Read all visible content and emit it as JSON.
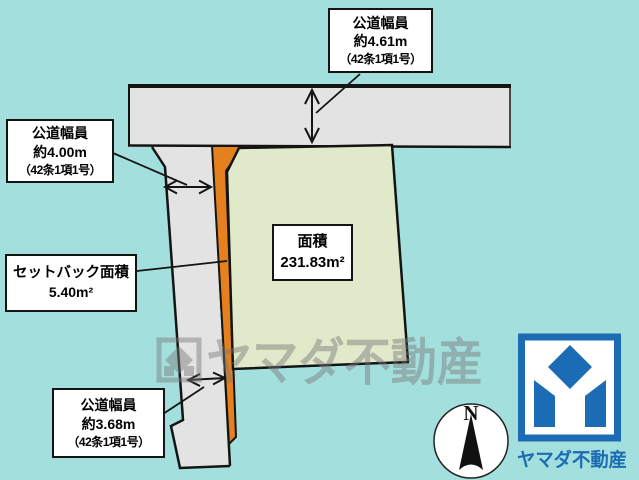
{
  "labels": {
    "road_top": {
      "title": "公道幅員",
      "value": "約4.61m",
      "note": "（42条1項1号）"
    },
    "road_left": {
      "title": "公道幅員",
      "value": "約4.00m",
      "note": "（42条1項1号）"
    },
    "road_bottom": {
      "title": "公道幅員",
      "value": "約3.68m",
      "note": "（42条1項1号）"
    },
    "setback": {
      "title": "セットバック面積",
      "value": "5.40m²"
    },
    "area": {
      "title": "面積",
      "value": "231.83m²"
    }
  },
  "compass": {
    "label": "N"
  },
  "watermark": {
    "text": "ヤマダ不動産"
  },
  "logo": {
    "text": "ヤマダ不動産"
  },
  "colors": {
    "background": "#a3e0dd",
    "road_fill": "#e3e3e3",
    "plot_fill": "#e0e9c9",
    "setback_strip": "#e5801f",
    "outline": "#141414",
    "brand_blue": "#1b6cb4",
    "watermark_gray": "#787878"
  }
}
